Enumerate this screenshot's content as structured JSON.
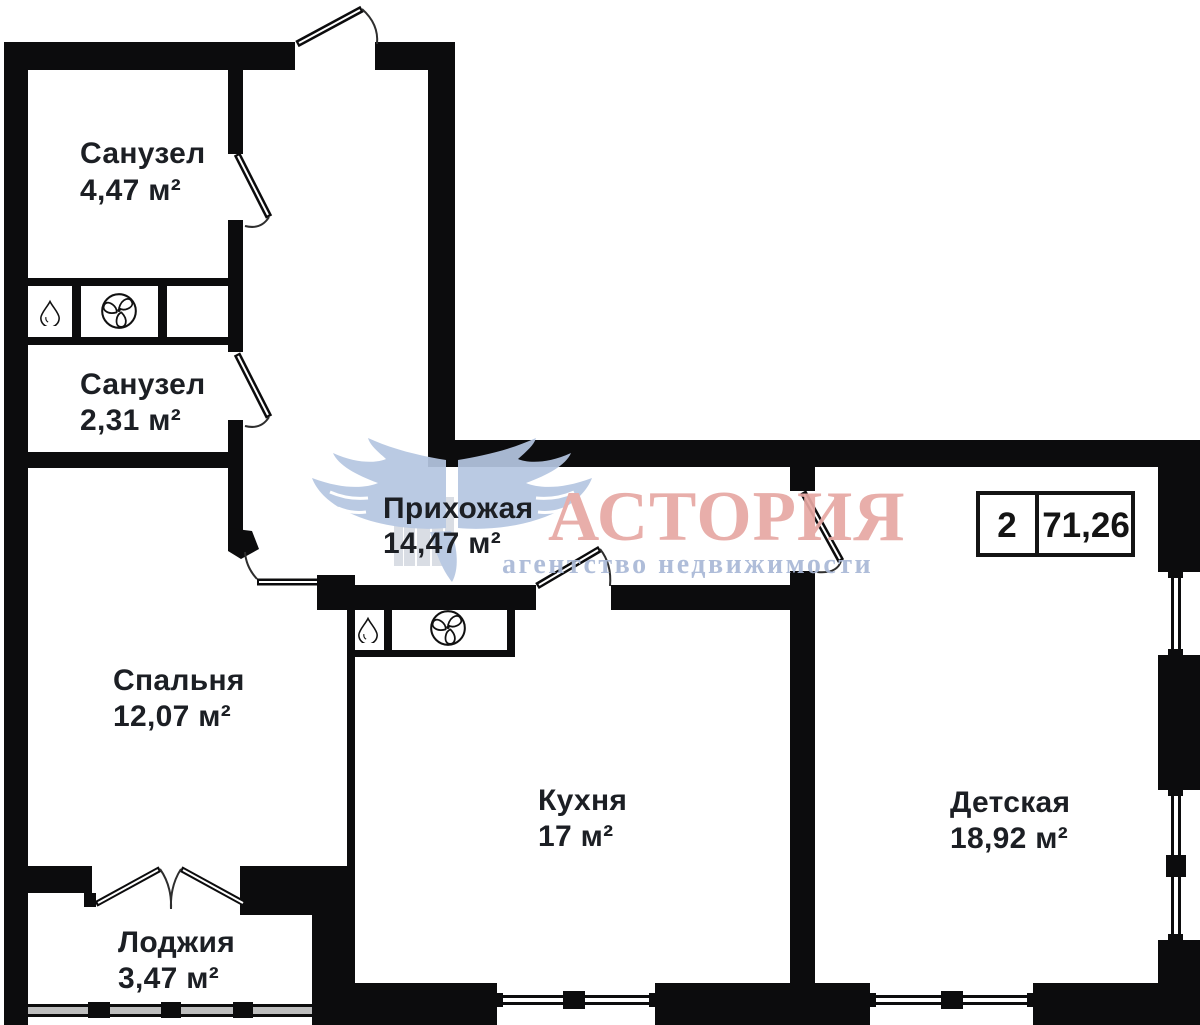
{
  "plan": {
    "rooms": [
      {
        "id": "sanuzel-1",
        "name": "Санузел",
        "area": "4,47 м²"
      },
      {
        "id": "sanuzel-2",
        "name": "Санузел",
        "area": "2,31 м²"
      },
      {
        "id": "prihozhaya",
        "name": "Прихожая",
        "area": "14,47 м²"
      },
      {
        "id": "spalnya",
        "name": "Спальня",
        "area": "12,07 м²"
      },
      {
        "id": "kuhnya",
        "name": "Кухня",
        "area": "17 м²"
      },
      {
        "id": "detskaya",
        "name": "Детская",
        "area": "18,92 м²"
      },
      {
        "id": "lodzhiya",
        "name": "Лоджия",
        "area": "3,47 м²"
      }
    ],
    "badge": {
      "rooms_count": "2",
      "total_area": "71,26"
    }
  },
  "logo": {
    "brand": "АСТОРИЯ",
    "tagline": "агентство недвижимости"
  },
  "colors": {
    "wall": "#0c0c0d",
    "label": "#1c1f24",
    "brand_pink": "#e7a8a3",
    "brand_blue": "#a9b8d6",
    "wing_blue": "#b5c6e1",
    "building_gray": "#d6dbe2"
  }
}
